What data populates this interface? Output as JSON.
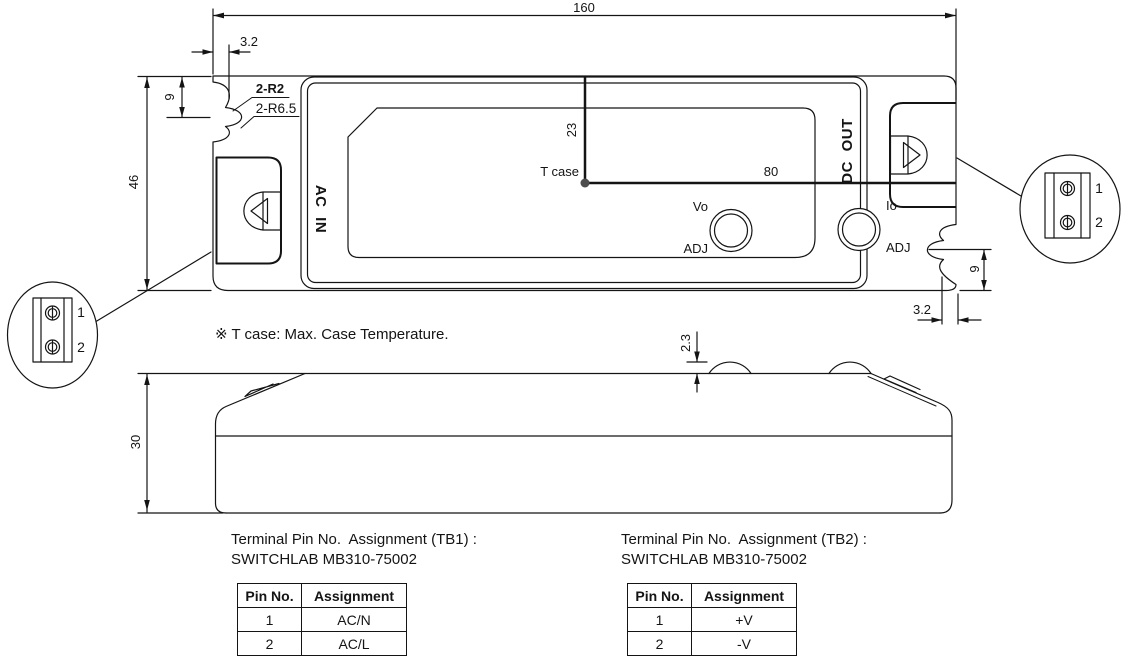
{
  "top_view": {
    "dim_width": "160",
    "dim_height": "46",
    "dim_slot_offset_top": "3.2",
    "dim_slot_top": "9",
    "radius_label_1": "2-R2",
    "radius_label_2": "2-R6.5",
    "dim_tcase_top": "23",
    "dim_tcase_right": "80",
    "dim_slot_bottom": "9",
    "dim_slot_offset_bottom": "3.2",
    "tcase_label": "T case",
    "ac_in": "AC IN",
    "dc_out": "DC OUT",
    "vo": "Vo",
    "io": "Io",
    "adj": "ADJ"
  },
  "side_view": {
    "dim_height": "30",
    "dim_bump": "2.3"
  },
  "note": "※ T case: Max. Case Temperature.",
  "callouts": {
    "left": {
      "pins": [
        "1",
        "2"
      ]
    },
    "right": {
      "pins": [
        "1",
        "2"
      ]
    }
  },
  "tables": [
    {
      "title": "Terminal Pin No.  Assignment (TB1) :",
      "subtitle": "SWITCHLAB MB310-75002",
      "headers": [
        "Pin No.",
        "Assignment"
      ],
      "rows": [
        [
          "1",
          "AC/N"
        ],
        [
          "2",
          "AC/L"
        ]
      ]
    },
    {
      "title": "Terminal Pin No.  Assignment (TB2) :",
      "subtitle": "SWITCHLAB MB310-75002",
      "headers": [
        "Pin No.",
        "Assignment"
      ],
      "rows": [
        [
          "1",
          "+V"
        ],
        [
          "2",
          "-V"
        ]
      ]
    }
  ],
  "colors": {
    "line": "#141414",
    "background": "#ffffff"
  }
}
